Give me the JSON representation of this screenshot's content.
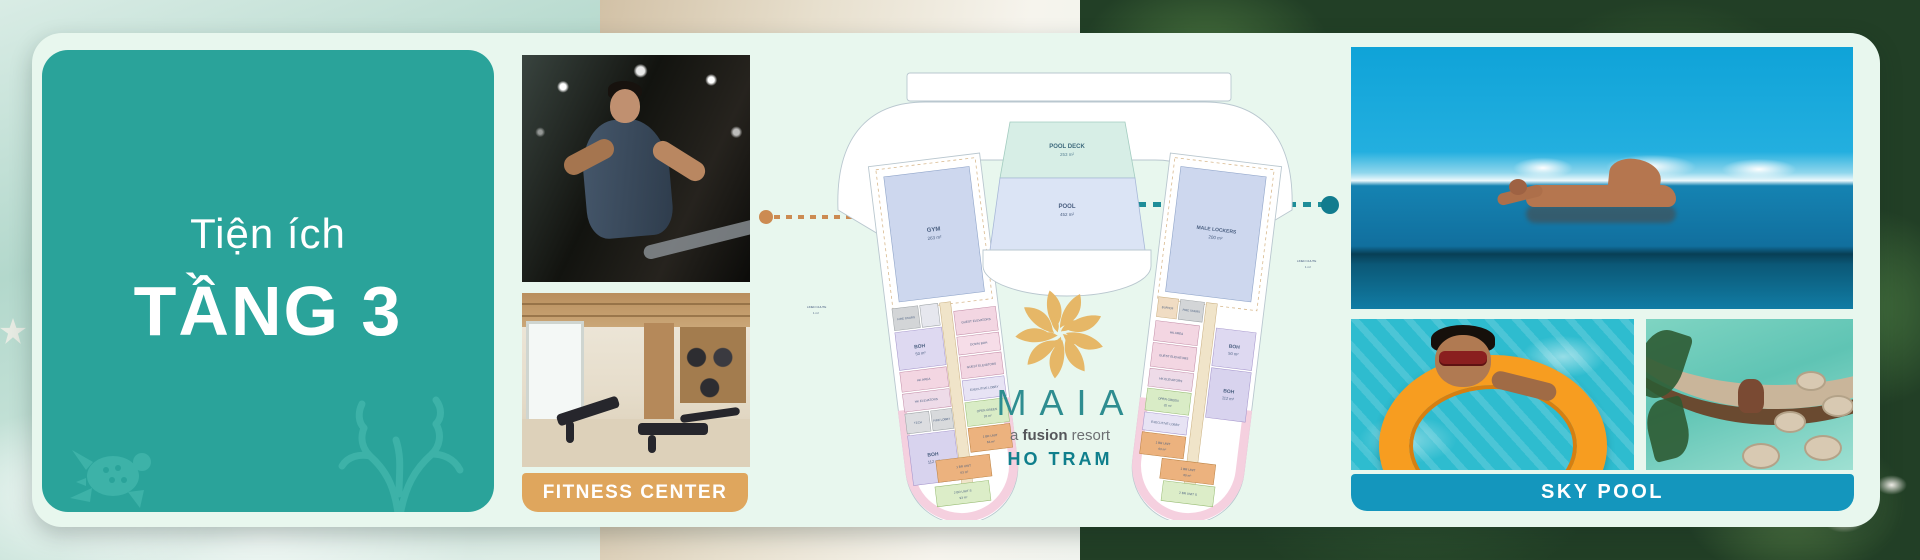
{
  "title_card": {
    "line1": "Tiện ích",
    "line2": "TẦNG 3"
  },
  "fitness": {
    "banner": "FITNESS CENTER"
  },
  "sky_pool": {
    "banner": "SKY POOL"
  },
  "logo": {
    "brand": "MAIA",
    "tagline_pre": "a",
    "tagline_bold": "fusion",
    "tagline_post": "resort",
    "location": "HO TRAM"
  },
  "floorplan": {
    "pool_deck": {
      "name": "POOL DECK",
      "area": "253 m²"
    },
    "pool": {
      "name": "POOL",
      "area": "452 m²"
    },
    "gym": {
      "name": "GYM",
      "area": "263 m²"
    },
    "male_lockers": {
      "name": "MALE LOCKERS",
      "area": "200 m²"
    },
    "left_rooms": [
      {
        "name": "FIRE STAIRS"
      },
      {
        "name": "BOH",
        "area": "50 m²"
      },
      {
        "name": "GUEST ELEVATORS"
      },
      {
        "name": "DOWN BOH"
      },
      {
        "name": "GUEST ELEVATORS"
      },
      {
        "name": "HK AREA"
      },
      {
        "name": "HK ELEVATORS"
      },
      {
        "name": "TECH"
      },
      {
        "name": "FIRE LOBBY"
      },
      {
        "name": "BOH",
        "area": "112 m²"
      },
      {
        "name": "EXECUTIVE LOBBY"
      },
      {
        "name": "OPEN GREEN",
        "area": "26 m²"
      },
      {
        "name": "1 BR UNIT",
        "area": "63 m²"
      },
      {
        "name": "1 BR UNIT",
        "area": "63 m²"
      },
      {
        "name": "2 BR UNIT S",
        "area": "93 m²"
      },
      {
        "name": "LINEN CHUTE",
        "area": "1 m²"
      }
    ],
    "right_rooms": [
      {
        "name": "BUFFER"
      },
      {
        "name": "FIRE STAIRS"
      },
      {
        "name": "BOH",
        "area": "50 m²"
      },
      {
        "name": "HK AREA"
      },
      {
        "name": "GUEST ELEVATORS"
      },
      {
        "name": "HK ELEVATORS"
      },
      {
        "name": "BOH",
        "area": "112 m²"
      },
      {
        "name": "OPEN GREEN",
        "area": "32 m²"
      },
      {
        "name": "EXECUTIVE LOBBY"
      },
      {
        "name": "1 BR UNIT",
        "area": "63 m²"
      },
      {
        "name": "1 BR UNIT",
        "area": "60 m²"
      },
      {
        "name": "2 BR UNIT S"
      },
      {
        "name": "LINEN CHUTE",
        "area": "1 m²"
      }
    ]
  },
  "colors": {
    "teal_card": "#2AA39A",
    "mint_panel": "#E8F7EE",
    "fitness_banner": "#DFA65D",
    "sky_banner": "#1496BD",
    "logo_gold": "#E6B767",
    "logo_teal": "#2E8D90",
    "connector_orange": "#CC8B52",
    "connector_teal": "#117C8E"
  }
}
